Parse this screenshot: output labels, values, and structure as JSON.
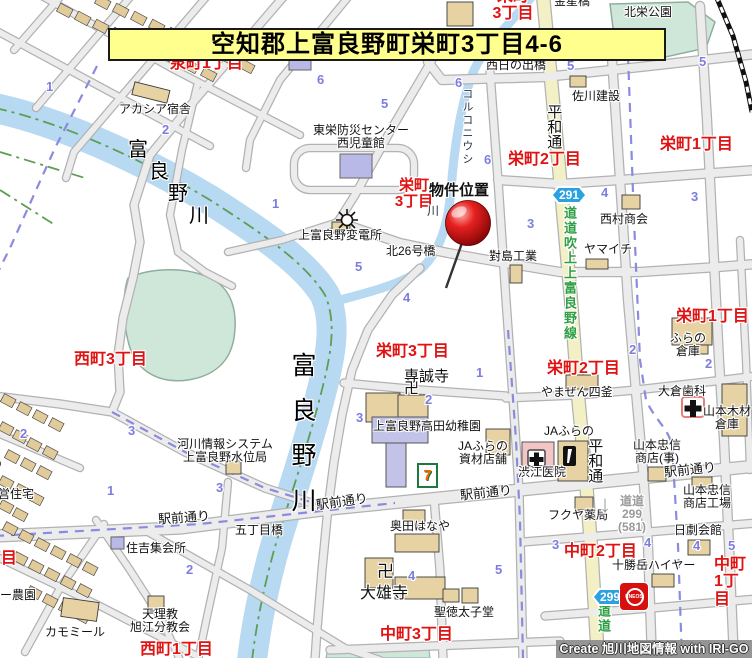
{
  "banner": {
    "text": "空知郡上富良野町栄町3丁目4-6"
  },
  "credit": {
    "text": "Create 旭川地図情報 with IRI-GO"
  },
  "badges": {
    "route291": "291",
    "route299": "299",
    "eneos": "ENEOS",
    "seven": "7"
  },
  "marker": {
    "label": "物件位置"
  },
  "labels": [
    {
      "t": "栄町\n3丁目",
      "x": 480,
      "y": -12,
      "w": 66,
      "ta": 1,
      "fs": 16,
      "c": "red",
      "n": "district-label-sakaemachi3-top"
    },
    {
      "t": "泉町1丁目",
      "x": 170,
      "y": 55,
      "fs": 16,
      "c": "red",
      "n": "district-label-izumicho1"
    },
    {
      "t": "栄町2丁目",
      "x": 508,
      "y": 151,
      "fs": 16,
      "c": "red",
      "n": "district-label-sakaemachi2-north"
    },
    {
      "t": "栄町1丁目",
      "x": 660,
      "y": 136,
      "fs": 16,
      "c": "red",
      "n": "district-label-sakaemachi1-north"
    },
    {
      "t": "栄町\n3丁目",
      "x": 386,
      "y": 178,
      "w": 56,
      "ta": 1,
      "fs": 15,
      "c": "red",
      "n": "district-label-sakaemachi3-pin"
    },
    {
      "t": "栄町1丁目",
      "x": 676,
      "y": 308,
      "fs": 16,
      "c": "red",
      "n": "district-label-sakaemachi1-mid"
    },
    {
      "t": "栄町2丁目",
      "x": 547,
      "y": 360,
      "fs": 16,
      "c": "red",
      "n": "district-label-sakaemachi2-south"
    },
    {
      "t": "栄町3丁目",
      "x": 376,
      "y": 343,
      "fs": 16,
      "c": "red",
      "n": "district-label-sakaemachi3-mid"
    },
    {
      "t": "西町3丁目",
      "x": 74,
      "y": 351,
      "fs": 16,
      "c": "red",
      "n": "district-label-nishimachi3"
    },
    {
      "t": "西町1丁目",
      "x": 140,
      "y": 641,
      "fs": 16,
      "c": "red",
      "n": "district-label-nishimachi1"
    },
    {
      "t": "西町2丁目",
      "x": -56,
      "y": 550,
      "fs": 16,
      "c": "red",
      "n": "district-label-nishimachi2"
    },
    {
      "t": "中町3丁目",
      "x": 380,
      "y": 626,
      "fs": 16,
      "c": "red",
      "n": "district-label-nakamachi3"
    },
    {
      "t": "中町2丁目",
      "x": 564,
      "y": 543,
      "fs": 16,
      "c": "red",
      "n": "district-label-nakamachi2"
    },
    {
      "t": "中町1丁目",
      "x": 714,
      "y": 556,
      "fs": 16,
      "c": "red",
      "n": "district-label-nakamachi1"
    },
    {
      "t": "金星橋",
      "x": 554,
      "y": -5,
      "c": "poi",
      "n": "bridge-label-kinseibashi"
    },
    {
      "t": "北栄公園",
      "x": 624,
      "y": 6,
      "c": "poi",
      "n": "park-label-hokuei"
    },
    {
      "t": "西日の出橋",
      "x": 486,
      "y": 59,
      "c": "poi",
      "n": "bridge-label-nishihinode"
    },
    {
      "t": "アカシア宿舎",
      "x": 119,
      "y": 103,
      "c": "poi",
      "n": "poi-label-acacia"
    },
    {
      "t": "佐川建設",
      "x": 572,
      "y": 90,
      "c": "poi",
      "n": "poi-label-sagawa"
    },
    {
      "t": "東栄防災センター\n西児童館",
      "x": 300,
      "y": 124,
      "w": 122,
      "ta": 1,
      "c": "poi",
      "n": "poi-label-bousai-center"
    },
    {
      "t": "上富良野変電所",
      "x": 298,
      "y": 229,
      "c": "poi",
      "n": "poi-label-substation"
    },
    {
      "t": "北26号橋",
      "x": 386,
      "y": 245,
      "c": "poi",
      "n": "bridge-label-kita26"
    },
    {
      "t": "對島工業",
      "x": 489,
      "y": 250,
      "c": "poi",
      "n": "poi-label-tsushima"
    },
    {
      "t": "西村商会",
      "x": 600,
      "y": 213,
      "c": "poi",
      "n": "poi-label-nishimura"
    },
    {
      "t": "ヤマイチ",
      "x": 584,
      "y": 243,
      "c": "poi",
      "n": "poi-label-yamaichi"
    },
    {
      "t": "ふらの\n倉庫",
      "x": 662,
      "y": 332,
      "w": 52,
      "ta": 1,
      "c": "poi",
      "n": "poi-label-furano-souko"
    },
    {
      "t": "大倉歯科",
      "x": 658,
      "y": 385,
      "c": "poi",
      "n": "poi-label-okura-dental"
    },
    {
      "t": "山本木材\n倉庫",
      "x": 700,
      "y": 405,
      "w": 54,
      "ta": 1,
      "c": "poi",
      "n": "poi-label-yamamoto-mokuzai"
    },
    {
      "t": "やまぜん四釜",
      "x": 541,
      "y": 386,
      "c": "poi",
      "n": "poi-label-yamazen"
    },
    {
      "t": "JAふらの",
      "x": 544,
      "y": 425,
      "c": "poi",
      "n": "poi-label-ja-furano"
    },
    {
      "t": "山本忠信\n商店(事)",
      "x": 626,
      "y": 439,
      "w": 62,
      "ta": 1,
      "c": "poi",
      "n": "poi-label-yamamoto-chushin-office"
    },
    {
      "t": "渋江医院",
      "x": 518,
      "y": 466,
      "c": "poi",
      "n": "poi-label-shibue-clinic"
    },
    {
      "t": "JAふらの\n資材店舗",
      "x": 454,
      "y": 440,
      "w": 58,
      "ta": 1,
      "c": "poi",
      "n": "poi-label-ja-shizai"
    },
    {
      "t": "上富良野高田幼稚園",
      "x": 373,
      "y": 420,
      "c": "poi",
      "n": "poi-label-takada-kindergarten"
    },
    {
      "t": "専誠寺",
      "x": 404,
      "y": 369,
      "fs": 15,
      "c": "poi",
      "n": "poi-label-senseiji"
    },
    {
      "t": "卍",
      "x": 404,
      "y": 381,
      "fs": 15,
      "c": "poi",
      "n": "temple-manji-icon-senseiji"
    },
    {
      "t": "奥田はなや",
      "x": 390,
      "y": 520,
      "c": "poi",
      "n": "poi-label-okuda-hanaya"
    },
    {
      "t": "大雄寺",
      "x": 360,
      "y": 585,
      "fs": 16,
      "c": "poi",
      "n": "poi-label-daiyuji"
    },
    {
      "t": "卍",
      "x": 377,
      "y": 563,
      "fs": 17,
      "c": "poi",
      "n": "temple-manji-icon-daiyuji"
    },
    {
      "t": "聖徳太子堂",
      "x": 434,
      "y": 606,
      "c": "poi",
      "n": "poi-label-shotokutaishido"
    },
    {
      "t": "フクヤ薬局",
      "x": 548,
      "y": 509,
      "c": "poi",
      "n": "poi-label-fukuya-pharmacy"
    },
    {
      "t": "十勝岳ハイヤー",
      "x": 612,
      "y": 559,
      "c": "poi",
      "n": "poi-label-tokachidake-hire"
    },
    {
      "t": "日劇会館",
      "x": 674,
      "y": 524,
      "c": "poi",
      "n": "poi-label-nichigeki"
    },
    {
      "t": "山本忠信\n商店工場",
      "x": 676,
      "y": 484,
      "w": 62,
      "ta": 1,
      "c": "poi",
      "n": "poi-label-yamamoto-chushin-factory"
    },
    {
      "t": "河川情報システム\n上富良野水位局",
      "x": 166,
      "y": 438,
      "w": 118,
      "ta": 1,
      "c": "poi",
      "n": "poi-label-water-level-station"
    },
    {
      "t": "公営住宅",
      "x": -14,
      "y": 488,
      "c": "poi",
      "n": "poi-label-public-housing"
    },
    {
      "t": "住吉集会所",
      "x": 126,
      "y": 542,
      "c": "poi",
      "n": "poi-label-sumiyoshi-hall"
    },
    {
      "t": "天理教\n旭江分教会",
      "x": 122,
      "y": 608,
      "w": 76,
      "ta": 1,
      "c": "poi",
      "n": "poi-label-tenrikyo"
    },
    {
      "t": "カモミール",
      "x": 45,
      "y": 626,
      "c": "poi",
      "n": "poi-label-chamomile"
    },
    {
      "t": "フラワー農園",
      "x": -36,
      "y": 589,
      "c": "poi",
      "n": "poi-label-flower-farm"
    },
    {
      "t": "五丁目橋",
      "x": 235,
      "y": 524,
      "c": "poi",
      "n": "bridge-label-gochome"
    },
    {
      "t": "物件位置",
      "x": 429,
      "y": 183,
      "fs": 15,
      "b": 1,
      "c": "poi",
      "n": "property-location-label"
    },
    {
      "t": "駅前通り",
      "x": -46,
      "y": 466,
      "r": -28,
      "fs": 13,
      "c": "poi",
      "n": "road-label-ekimae-1"
    },
    {
      "t": "駅前通り",
      "x": 158,
      "y": 511,
      "r": -4,
      "fs": 13,
      "c": "poi",
      "n": "road-label-ekimae-2"
    },
    {
      "t": "駅前通り",
      "x": 316,
      "y": 495,
      "r": -8,
      "fs": 13,
      "c": "poi",
      "n": "road-label-ekimae-3"
    },
    {
      "t": "駅前通り",
      "x": 460,
      "y": 486,
      "r": -6,
      "fs": 13,
      "c": "poi",
      "n": "road-label-ekimae-4"
    },
    {
      "t": "駅前通り",
      "x": 664,
      "y": 463,
      "r": -6,
      "fs": 13,
      "c": "poi",
      "n": "road-label-ekimae-5"
    },
    {
      "t": "平和通",
      "x": 545,
      "y": 104,
      "v": 1,
      "fs": 15,
      "c": "poi",
      "n": "road-label-heiwa-dori-north"
    },
    {
      "t": "平和通",
      "x": 586,
      "y": 438,
      "v": 1,
      "fs": 15,
      "c": "poi",
      "n": "road-label-heiwa-dori-south"
    },
    {
      "t": "富",
      "x": 128,
      "y": 140,
      "fs": 20,
      "c": "riv",
      "n": "river-label-furano-char"
    },
    {
      "t": "良",
      "x": 149,
      "y": 162,
      "fs": 20,
      "c": "riv",
      "n": "river-label-furano-char"
    },
    {
      "t": "野",
      "x": 168,
      "y": 184,
      "fs": 20,
      "c": "riv",
      "n": "river-label-furano-char"
    },
    {
      "t": "川",
      "x": 189,
      "y": 206,
      "fs": 20,
      "c": "riv",
      "n": "river-label-furano-char"
    },
    {
      "t": "富良野川",
      "x": 288,
      "y": 352,
      "v": 1,
      "fs": 25,
      "ls": 20,
      "c": "riv",
      "n": "river-label-furano-south"
    },
    {
      "t": "コルコニウシ",
      "x": 460,
      "y": 88,
      "v": 1,
      "fs": 11,
      "ls": 2,
      "c": "riv2",
      "n": "river-label-korukoniushi"
    },
    {
      "t": "川",
      "x": 427,
      "y": 205,
      "fs": 12,
      "c": "riv2",
      "n": "river-label-korukoniushi-kawa"
    },
    {
      "t": "道道吹上上富良野線",
      "x": 562,
      "y": 206,
      "v": 1,
      "fs": 13,
      "ls": 2,
      "c": "grn",
      "n": "route-label-dodo-fukiage"
    },
    {
      "t": "道道",
      "x": 596,
      "y": 604,
      "v": 1,
      "fs": 13,
      "ls": 2,
      "c": "grn",
      "n": "route-label-dodo-bottom"
    },
    {
      "t": "道道\n299\n(581)",
      "x": 612,
      "y": 495,
      "w": 40,
      "ta": 1,
      "fs": 12,
      "c": "gry",
      "n": "route-label-dodo-299"
    },
    {
      "t": "↓",
      "x": 599,
      "y": 492,
      "fs": 24,
      "c": "gry",
      "n": "route-arrow-down-icon"
    }
  ],
  "numbers": [
    {
      "t": "1",
      "x": 46,
      "y": 80
    },
    {
      "t": "2",
      "x": 162,
      "y": 123
    },
    {
      "t": "1",
      "x": 272,
      "y": 197
    },
    {
      "t": "6",
      "x": 317,
      "y": 73
    },
    {
      "t": "5",
      "x": 381,
      "y": 97
    },
    {
      "t": "6",
      "x": 455,
      "y": 76
    },
    {
      "t": "5",
      "x": 567,
      "y": 59
    },
    {
      "t": "5",
      "x": 699,
      "y": 55
    },
    {
      "t": "6",
      "x": 484,
      "y": 153
    },
    {
      "t": "4",
      "x": 601,
      "y": 186
    },
    {
      "t": "3",
      "x": 691,
      "y": 190
    },
    {
      "t": "3",
      "x": 527,
      "y": 217
    },
    {
      "t": "5",
      "x": 355,
      "y": 260
    },
    {
      "t": "4",
      "x": 403,
      "y": 291
    },
    {
      "t": "2",
      "x": 629,
      "y": 343
    },
    {
      "t": "2",
      "x": 705,
      "y": 357
    },
    {
      "t": "1",
      "x": 476,
      "y": 366
    },
    {
      "t": "2",
      "x": 425,
      "y": 393
    },
    {
      "t": "3",
      "x": 356,
      "y": 411
    },
    {
      "t": "3",
      "x": 128,
      "y": 424
    },
    {
      "t": "2",
      "x": 20,
      "y": 427
    },
    {
      "t": "1",
      "x": 107,
      "y": 484
    },
    {
      "t": "3",
      "x": 216,
      "y": 481
    },
    {
      "t": "2",
      "x": 186,
      "y": 563
    },
    {
      "t": "4",
      "x": 408,
      "y": 569
    },
    {
      "t": "5",
      "x": 495,
      "y": 563
    },
    {
      "t": "3",
      "x": 552,
      "y": 538
    },
    {
      "t": "4",
      "x": 644,
      "y": 536
    },
    {
      "t": "4",
      "x": 693,
      "y": 539
    },
    {
      "t": "5",
      "x": 728,
      "y": 539
    }
  ]
}
